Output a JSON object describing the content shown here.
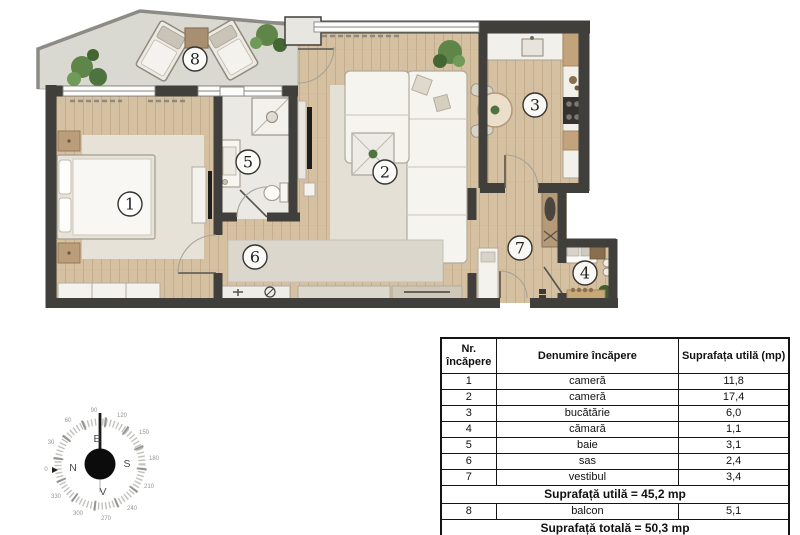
{
  "plan": {
    "rooms": [
      {
        "number": "1",
        "name": "cameră"
      },
      {
        "number": "2",
        "name": "cameră"
      },
      {
        "number": "3",
        "name": "bucătărie"
      },
      {
        "number": "4",
        "name": "cămară"
      },
      {
        "number": "5",
        "name": "baie"
      },
      {
        "number": "6",
        "name": "sas"
      },
      {
        "number": "7",
        "name": "vestibul"
      },
      {
        "number": "8",
        "name": "balcon"
      }
    ],
    "colors": {
      "wall": "#403f3b",
      "wood_floor": "#d5c1a1",
      "balcony_floor": "#d9d8d1",
      "tile_floor": "#ebe9e3",
      "rug": "#e7e2d7",
      "furniture_white": "#f6f4ef",
      "furniture_wood": "#c2a37b",
      "plant_green": "#5f8549",
      "appliance_dark": "#33322e"
    }
  },
  "compass": {
    "degrees": [
      "0",
      "30",
      "60",
      "90",
      "120",
      "150",
      "180",
      "210",
      "240",
      "270",
      "300",
      "330"
    ],
    "cardinals": {
      "top": "E",
      "right": "S",
      "bottom": "V",
      "left": "N"
    }
  },
  "table": {
    "headers": {
      "nr": "Nr. încăpere",
      "name": "Denumire încăpere",
      "area": "Suprafața utilă (mp)"
    },
    "rows": [
      {
        "nr": "1",
        "name": "cameră",
        "area": "11,8"
      },
      {
        "nr": "2",
        "name": "cameră",
        "area": "17,4"
      },
      {
        "nr": "3",
        "name": "bucătărie",
        "area": "6,0"
      },
      {
        "nr": "4",
        "name": "cămară",
        "area": "1,1"
      },
      {
        "nr": "5",
        "name": "baie",
        "area": "3,1"
      },
      {
        "nr": "6",
        "name": "sas",
        "area": "2,4"
      },
      {
        "nr": "7",
        "name": "vestibul",
        "area": "3,4"
      }
    ],
    "subtotal": "Suprafață utilă = 45,2 mp",
    "balcony_row": {
      "nr": "8",
      "name": "balcon",
      "area": "5,1"
    },
    "total": "Suprafață totală = 50,3 mp"
  }
}
